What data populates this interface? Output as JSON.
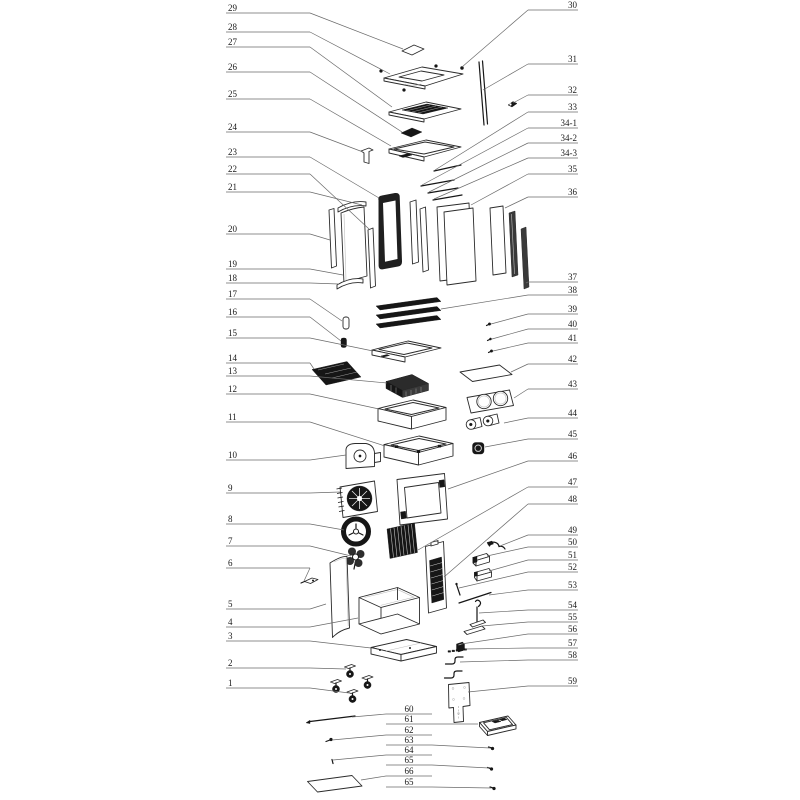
{
  "diagram": {
    "type": "exploded-parts-diagram",
    "background": "#ffffff",
    "ink": "#2b2b2b",
    "leader_color": "#6a6a6a"
  },
  "callouts": {
    "left": [
      {
        "label": "29",
        "y": 13,
        "tx": 403,
        "ty": 49
      },
      {
        "label": "28",
        "y": 32,
        "tx": 390,
        "ty": 74
      },
      {
        "label": "27",
        "y": 47,
        "tx": 392,
        "ty": 107
      },
      {
        "label": "26",
        "y": 72,
        "tx": 402,
        "ty": 132
      },
      {
        "label": "25",
        "y": 99,
        "tx": 391,
        "ty": 146
      },
      {
        "label": "24",
        "y": 132,
        "tx": 363,
        "ty": 152
      },
      {
        "label": "23",
        "y": 157,
        "tx": 379,
        "ty": 198
      },
      {
        "label": "22",
        "y": 174,
        "tx": 369,
        "ty": 229
      },
      {
        "label": "21",
        "y": 192,
        "tx": 362,
        "ty": 205
      },
      {
        "label": "20",
        "y": 234,
        "tx": 330,
        "ty": 240
      },
      {
        "label": "19",
        "y": 269,
        "tx": 343,
        "ty": 275
      },
      {
        "label": "18",
        "y": 283,
        "tx": 339,
        "ty": 284
      },
      {
        "label": "17",
        "y": 299,
        "tx": 342,
        "ty": 321
      },
      {
        "label": "16",
        "y": 317,
        "tx": 341,
        "ty": 341
      },
      {
        "label": "15",
        "y": 338,
        "tx": 373,
        "ty": 351
      },
      {
        "label": "14",
        "y": 363,
        "tx": 314,
        "ty": 369
      },
      {
        "label": "13",
        "y": 376,
        "tx": 387,
        "ty": 383
      },
      {
        "label": "12",
        "y": 394,
        "tx": 379,
        "ty": 409
      },
      {
        "label": "11",
        "y": 422,
        "tx": 385,
        "ty": 446
      },
      {
        "label": "10",
        "y": 460,
        "tx": 346,
        "ty": 455
      },
      {
        "label": "9",
        "y": 493,
        "tx": 340,
        "ty": 492
      },
      {
        "label": "8",
        "y": 524,
        "tx": 344,
        "ty": 530
      },
      {
        "label": "7",
        "y": 546,
        "tx": 351,
        "ty": 556
      },
      {
        "label": "6",
        "y": 568,
        "tx": 304,
        "ty": 581
      },
      {
        "label": "5",
        "y": 609,
        "tx": 326,
        "ty": 604
      },
      {
        "label": "4",
        "y": 627,
        "tx": 358,
        "ty": 618
      },
      {
        "label": "3",
        "y": 641,
        "tx": 371,
        "ty": 648
      },
      {
        "label": "2",
        "y": 668,
        "tx": 346,
        "ty": 669
      },
      {
        "label": "1",
        "y": 688,
        "tx": 349,
        "ty": 693
      }
    ],
    "right": [
      {
        "label": "30",
        "y": 10,
        "tx": 462,
        "ty": 67
      },
      {
        "label": "31",
        "y": 64,
        "tx": 483,
        "ty": 90
      },
      {
        "label": "32",
        "y": 95,
        "tx": 513,
        "ty": 103
      },
      {
        "label": "33",
        "y": 112,
        "tx": 435,
        "ty": 170
      },
      {
        "label": "34-1",
        "y": 128,
        "tx": 422,
        "ty": 185
      },
      {
        "label": "34-2",
        "y": 143,
        "tx": 429,
        "ty": 192
      },
      {
        "label": "34-3",
        "y": 158,
        "tx": 434,
        "ty": 199
      },
      {
        "label": "35",
        "y": 174,
        "tx": 471,
        "ty": 205
      },
      {
        "label": "36",
        "y": 197,
        "tx": 505,
        "ty": 208
      },
      {
        "label": "37",
        "y": 282,
        "tx": 526,
        "ty": 283
      },
      {
        "label": "38",
        "y": 295,
        "tx": 441,
        "ty": 309
      },
      {
        "label": "39",
        "y": 314,
        "tx": 491,
        "ty": 324
      },
      {
        "label": "40",
        "y": 329,
        "tx": 492,
        "ty": 339
      },
      {
        "label": "41",
        "y": 343,
        "tx": 493,
        "ty": 351
      },
      {
        "label": "42",
        "y": 364,
        "tx": 511,
        "ty": 372
      },
      {
        "label": "43",
        "y": 389,
        "tx": 514,
        "ty": 398
      },
      {
        "label": "44",
        "y": 418,
        "tx": 504,
        "ty": 423
      },
      {
        "label": "45",
        "y": 439,
        "tx": 485,
        "ty": 447
      },
      {
        "label": "46",
        "y": 461,
        "tx": 448,
        "ty": 489
      },
      {
        "label": "47",
        "y": 487,
        "tx": 418,
        "ty": 550
      },
      {
        "label": "48",
        "y": 504,
        "tx": 444,
        "ty": 577
      },
      {
        "label": "49",
        "y": 535,
        "tx": 500,
        "ty": 546
      },
      {
        "label": "50",
        "y": 547,
        "tx": 487,
        "ty": 556
      },
      {
        "label": "51",
        "y": 560,
        "tx": 489,
        "ty": 571
      },
      {
        "label": "52",
        "y": 572,
        "tx": 459,
        "ty": 588
      },
      {
        "label": "53",
        "y": 590,
        "tx": 489,
        "ty": 595
      },
      {
        "label": "54",
        "y": 610,
        "tx": 479,
        "ty": 613
      },
      {
        "label": "55",
        "y": 622,
        "tx": 482,
        "ty": 626
      },
      {
        "label": "56",
        "y": 634,
        "tx": 461,
        "ty": 644
      },
      {
        "label": "57",
        "y": 648,
        "tx": 465,
        "ty": 649
      },
      {
        "label": "58",
        "y": 660,
        "tx": 460,
        "ty": 662
      },
      {
        "label": "59",
        "y": 686,
        "tx": 468,
        "ty": 692
      }
    ],
    "bottom": [
      {
        "label": "60",
        "y": 714,
        "dir": "left",
        "tx": 352,
        "ty": 717
      },
      {
        "label": "61",
        "y": 724,
        "dir": "right",
        "tx": 478,
        "ty": 724
      },
      {
        "label": "62",
        "y": 735,
        "dir": "left",
        "tx": 332,
        "ty": 740
      },
      {
        "label": "63",
        "y": 745,
        "dir": "right",
        "tx": 490,
        "ty": 748
      },
      {
        "label": "64",
        "y": 755,
        "dir": "left",
        "tx": 333,
        "ty": 760
      },
      {
        "label": "65",
        "y": 765,
        "dir": "right",
        "tx": 489,
        "ty": 768
      },
      {
        "label": "66",
        "y": 776,
        "dir": "left",
        "tx": 361,
        "ty": 780
      },
      {
        "label": "65",
        "y": 787,
        "dir": "right",
        "tx": 491,
        "ty": 788
      }
    ]
  }
}
